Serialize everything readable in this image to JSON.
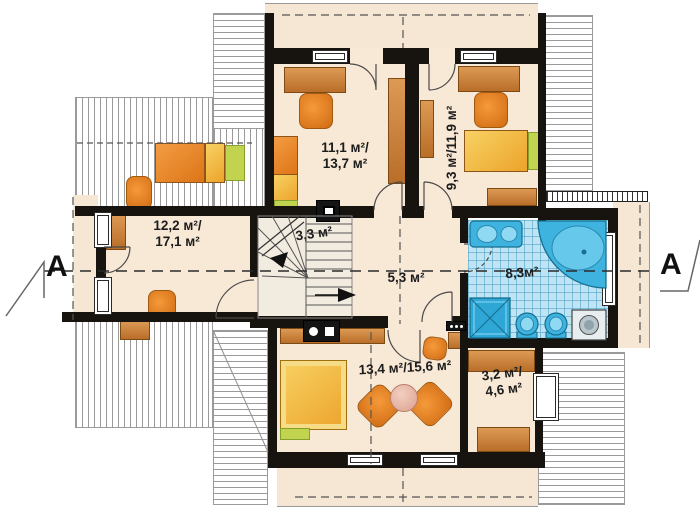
{
  "drawing_type": "attic floor plan",
  "rooms": {
    "upper_left": {
      "line1": "11,1 м²/",
      "line2": "13,7 м²"
    },
    "upper_right": {
      "label": "9,3 м²/11,9 м²"
    },
    "left": {
      "line1": "12,2 м²/",
      "line2": "17,1 м²"
    },
    "stairs": {
      "label": "3,3 м²"
    },
    "hall": {
      "label": "5,3 м²"
    },
    "bath": {
      "label": "8,3м²"
    },
    "lower": {
      "label": "13,4 м²/15,6 м²"
    },
    "closet": {
      "line1": "3,2 м²/",
      "line2": "4,6 м²"
    }
  },
  "section": {
    "left": "A",
    "right": "A"
  },
  "palette": {
    "floor": "#f8e8d6",
    "wall": "#17130e",
    "furniture_orange": "#e8882f",
    "furniture_yellow": "#f2c43c",
    "accent_green": "#c2d44f",
    "wood_brown": "#c97f3d",
    "tile_blue": "#bfe4f3",
    "fixture_blue": "#3eb3e0"
  }
}
